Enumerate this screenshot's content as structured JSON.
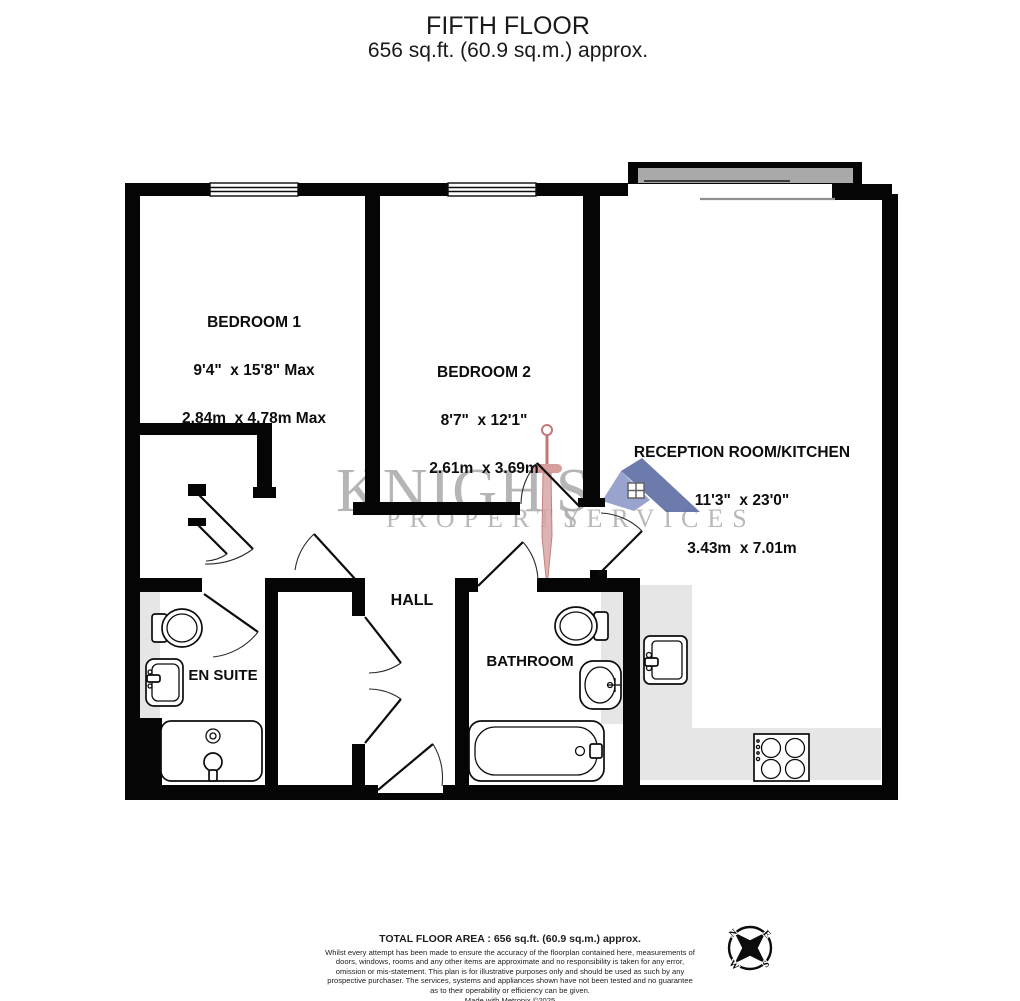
{
  "header": {
    "floor_title": "FIFTH FLOOR",
    "floor_area": "656 sq.ft. (60.9 sq.m.) approx."
  },
  "rooms": {
    "bedroom1": {
      "name": "BEDROOM 1",
      "imperial": "9'4\"  x 15'8\" Max",
      "metric": "2.84m  x 4.78m Max"
    },
    "bedroom2": {
      "name": "BEDROOM 2",
      "imperial": "8'7\"  x 12'1\"",
      "metric": "2.61m  x 3.69m"
    },
    "reception": {
      "name": "RECEPTION ROOM/KITCHEN",
      "imperial": "11'3\"  x 23'0\"",
      "metric": "3.43m  x 7.01m"
    },
    "hall": {
      "name": "HALL"
    },
    "ensuite": {
      "name": "EN SUITE"
    },
    "bathroom": {
      "name": "BATHROOM"
    }
  },
  "watermark": {
    "brand_left": "KNIGH",
    "brand_right": "S",
    "tagline_left": "PROPERTY",
    "tagline_right": "SERVICES"
  },
  "compass": {
    "north": "N",
    "east": "E",
    "south": "S",
    "west": "W"
  },
  "footer": {
    "total_area": "TOTAL FLOOR AREA : 656 sq.ft. (60.9 sq.m.) approx.",
    "disclaimer": "Whilst every attempt has been made to ensure the accuracy of the floorplan contained here, measurements of doors, windows, rooms and any other items are approximate and no responsibility is taken for any error, omission or mis-statement. This plan is for illustrative purposes only and should be used as such by any prospective purchaser. The services, systems and appliances shown have not been tested and no guarantee as to their operability or efficiency can be given.",
    "credit": "Made with Metropix ©2025"
  },
  "icons": {
    "watermark_sword": "sword",
    "watermark_roof": "house-roof",
    "compass": "compass-rose"
  },
  "colors": {
    "wall": "#050505",
    "counter": "#e6e6e6",
    "window": "#a9a9a9",
    "watermark": "#a5a5a5",
    "sword": "#cf8e8c",
    "roof_dark": "#5d6da3",
    "roof_light": "#8f9bc9"
  }
}
